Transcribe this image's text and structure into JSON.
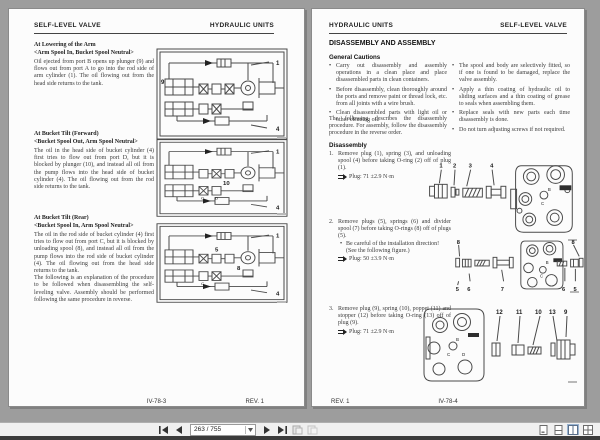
{
  "left": {
    "header_left": "SELF-LEVEL VALVE",
    "header_right": "HYDRAULIC UNITS",
    "sections": [
      {
        "title": "At Lowering of the Arm",
        "subtitle": "<Arm Spool In, Bucket Spool Neutral>",
        "body": "Oil ejected from port B opens up plunger (9) and flows out from port A to go into the rod side of arm cylinder (1). The oil flowing out from the head side returns to the tank.",
        "callout_left": "9",
        "callout_top": "1",
        "callout_bottom": "4"
      },
      {
        "title": "At Bucket Tilt (Forward)",
        "subtitle": "<Bucket Spool Out, Arm Spool Neutral>",
        "body": "The oil in the head side of bucket cylinder (4) first tries to flow out from port D, but it is blocked by plunger (10), and instead all oil from the pump flows into the head side of bucket cylinder (4). The oil flowing out from the rod side returns to the tank.",
        "callout_center": "10",
        "callout_top": "1",
        "callout_bottom": "4",
        "port_c": "C",
        "port_d": "D"
      },
      {
        "title": "At Bucket Tilt (Rear)",
        "subtitle": "<Bucket Spool In, Arm Spool Neutral>",
        "body": "The oil in the rod side of bucket cylinder (4) first tries to flow out from port C, but it is blocked by unloading spool (8), and instead all oil from the pump flows into the rod side of bucket cylinder (4). The oil flowing out from the head side returns to the tank.",
        "body2": "The following is an explanation of the procedure to be followed when disassembling the self-leveling valve. Assembly should be performed following the same procedure in reverse.",
        "callout_right": "8",
        "callout_mid": "5",
        "callout_top": "1",
        "callout_bottom": "4",
        "port_c": "C"
      }
    ],
    "footer_center": "IV-78-3",
    "footer_right": "REV. 1"
  },
  "right": {
    "header_left": "HYDRAULIC UNITS",
    "header_right": "SELF-LEVEL VALVE",
    "title": "DISASSEMBLY AND ASSEMBLY",
    "cautions_heading": "General Cautions",
    "cautions_left": [
      "Carry out disassembly and assembly operations in a clean place and place disassembled parts in clean containers.",
      "Before disassembly, clean thoroughly around the ports and remove paint or thread lock, etc. from all joints with a wire brush.",
      "Clean disassembled parts with light oil or other cleaning oil."
    ],
    "cautions_right": [
      "The spool and body are selectively fitted, so if one is found to be damaged, replace the valve assembly.",
      "Apply a thin coating of hydraulic oil to sliding surfaces and a thin coating of grease to seals when assembling them.",
      "Replace seals with new parts each time disassembly is done.",
      "Do not turn adjusting screws if not required."
    ],
    "intro": "The following describes the disassembly procedure. For assembly, follow the disassembly procedure in the reverse order.",
    "disassembly_heading": "Disassembly",
    "steps": [
      {
        "num": "1.",
        "text": "Remove plug (1), spring (3), and unloading spool (4) before taking O-ring (2) off of plug (1).",
        "torque": "Plug: 71 ±2.9 N·m"
      },
      {
        "num": "2.",
        "text": "Remove plugs (5), springs (6) and divider spool (7) before taking O-rings (8) off of plugs (5).",
        "note": "Be careful of the installation direction! (See the following figure.)",
        "torque": "Plug: 50 ±3.9 N·m"
      },
      {
        "num": "3.",
        "text": "Remove plug (9), spring (10), poppet (11) and stopper (12) before taking O-ring (13) off of plug (9).",
        "torque": "Plug: 71 ±2.9 N·m"
      }
    ],
    "fig1": {
      "n1": "1",
      "n2": "2",
      "n3": "3",
      "n4": "4",
      "port_b": "B",
      "port_c": "C"
    },
    "fig2": {
      "n8l": "8",
      "n5l": "5",
      "n6l": "6",
      "n7": "7",
      "n8r": "8",
      "n6r": "6",
      "n5r": "5",
      "port_b": "B",
      "port_c": "C"
    },
    "fig3": {
      "n12": "12",
      "n11": "11",
      "n10": "10",
      "n13": "13",
      "n9": "9",
      "port_b": "B",
      "port_c": "C",
      "port_d": "D"
    },
    "footer_left": "REV. 1",
    "footer_center": "IV-78-4"
  },
  "toolbar": {
    "page_field": "263 / 755"
  }
}
